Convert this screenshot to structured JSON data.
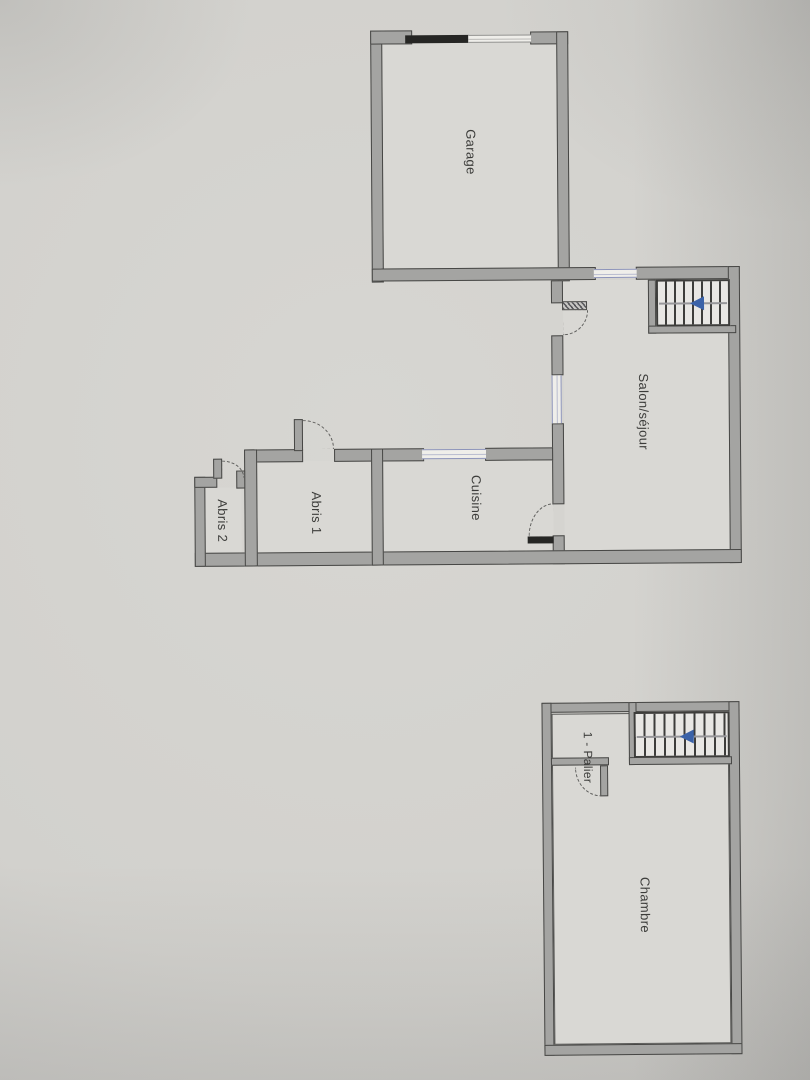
{
  "plan": {
    "ground_floor": {
      "rooms": [
        {
          "label": "Garage"
        },
        {
          "label": "Salon/séjour"
        },
        {
          "label": "Cuisine"
        },
        {
          "label": "Abris 1"
        },
        {
          "label": "Abris 2"
        }
      ],
      "stairs": {
        "icon": "stairs-direction-arrow-icon",
        "direction": "left"
      }
    },
    "first_floor": {
      "rooms": [
        {
          "label": "1 - Palier"
        },
        {
          "label": "Chambre"
        }
      ],
      "stairs": {
        "icon": "stairs-direction-arrow-icon",
        "direction": "left"
      }
    },
    "colors": {
      "paper": "#d2d1cd",
      "room_fill": "#d9d8d4",
      "wall_fill": "#a4a4a2",
      "wall_outline": "#474745",
      "window_accent": "#8d94ba",
      "stairs_arrow": "#3a62a8",
      "garage_door_bar": "#1f1f1d"
    }
  }
}
